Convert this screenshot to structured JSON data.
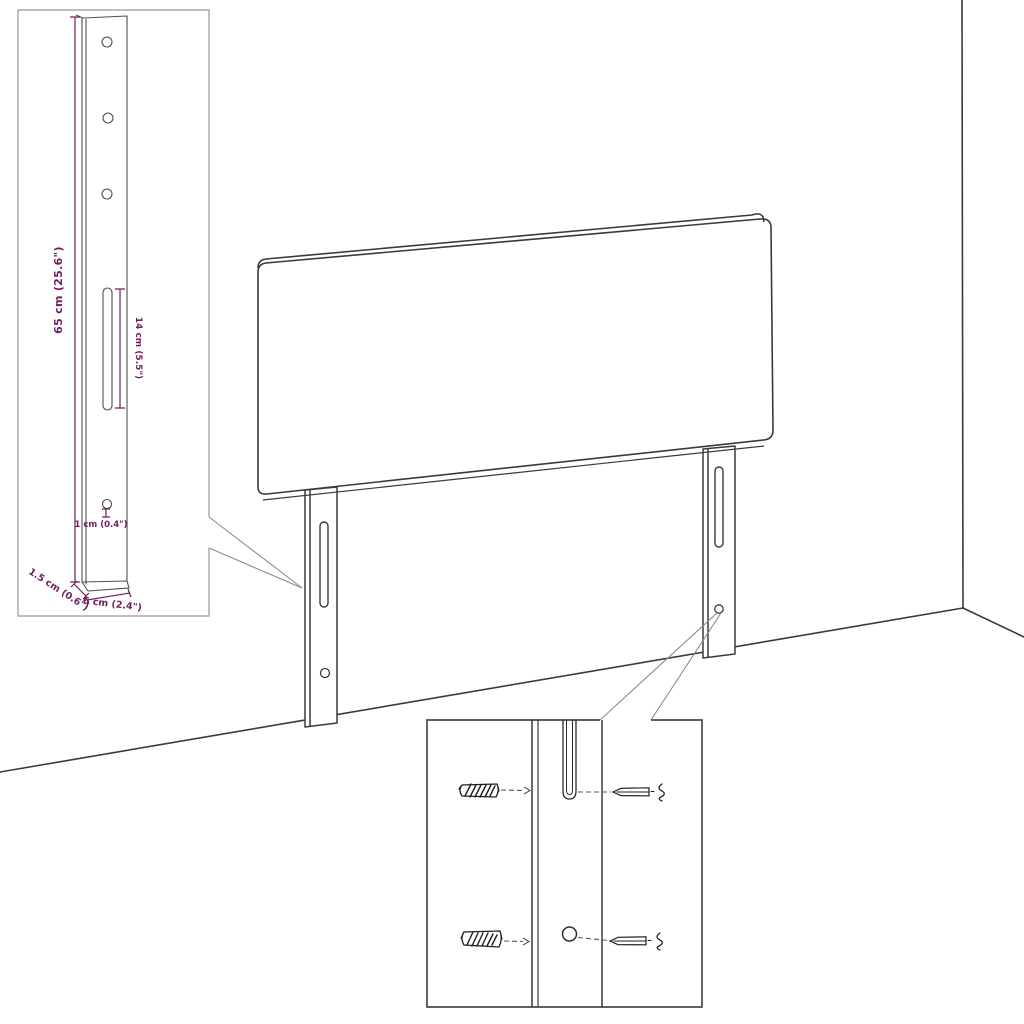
{
  "diagram": {
    "dimension_labels": {
      "leg_height": "65 cm (25.6\")",
      "slot_length": "14 cm (5.5\")",
      "hole_diameter": "1 cm (0.4\")",
      "leg_depth": "1.5 cm (0.6\")",
      "leg_width": "6 cm (2.4\")"
    },
    "colors": {
      "background": "#ffffff",
      "dimension_text": "#701f5e",
      "outline": "#3a3a3a",
      "detail_line": "#4f4f4f",
      "callout_line": "#8c8c8c",
      "hardware": "#222222"
    }
  }
}
